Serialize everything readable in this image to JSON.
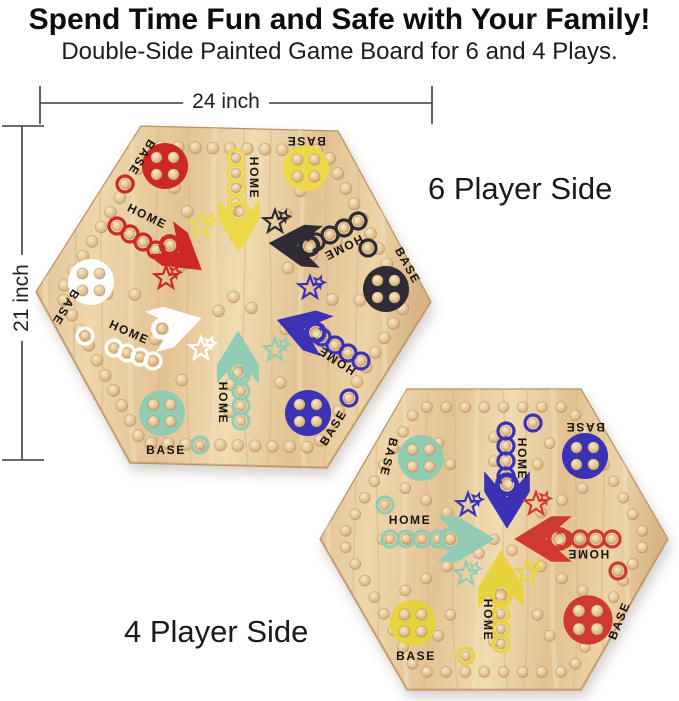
{
  "header": {
    "title": "Spend Time Fun and Safe with Your Family!",
    "subtitle": "Double-Side Painted Game Board for 6 and 4 Plays."
  },
  "dimensions": {
    "width_label": "24 inch",
    "height_label": "21 inch"
  },
  "materials": {
    "wood_hex": "#e6c89b",
    "label_ink_hex": "#181410"
  },
  "boards": {
    "six_player": {
      "caption": "6 Player Side",
      "players": [
        {
          "color_name": "red",
          "hex": "#cd2823",
          "base_label": "BASE",
          "home_label": "HOME"
        },
        {
          "color_name": "yellow",
          "hex": "#eed84a",
          "base_label": "BASE",
          "home_label": "HOME"
        },
        {
          "color_name": "black",
          "hex": "#2e2b35",
          "base_label": "BASE",
          "home_label": "HOME"
        },
        {
          "color_name": "blue",
          "hex": "#3c32b5",
          "base_label": "BASE",
          "home_label": "HOME"
        },
        {
          "color_name": "teal",
          "hex": "#92cbb3",
          "base_label": "BASE",
          "home_label": "HOME"
        },
        {
          "color_name": "white",
          "hex": "#ffffff",
          "base_label": "BASE",
          "home_label": "HOME"
        }
      ]
    },
    "four_player": {
      "caption": "4 Player Side",
      "players": [
        {
          "color_name": "teal",
          "hex": "#92cbb3",
          "base_label": "BASE",
          "home_label": "HOME"
        },
        {
          "color_name": "blue",
          "hex": "#3b31b4",
          "base_label": "BASE",
          "home_label": "HOME"
        },
        {
          "color_name": "red",
          "hex": "#cf3a30",
          "base_label": "BASE",
          "home_label": "HOME"
        },
        {
          "color_name": "yellow",
          "hex": "#e8d23e",
          "base_label": "BASE",
          "home_label": "HOME"
        }
      ]
    }
  }
}
